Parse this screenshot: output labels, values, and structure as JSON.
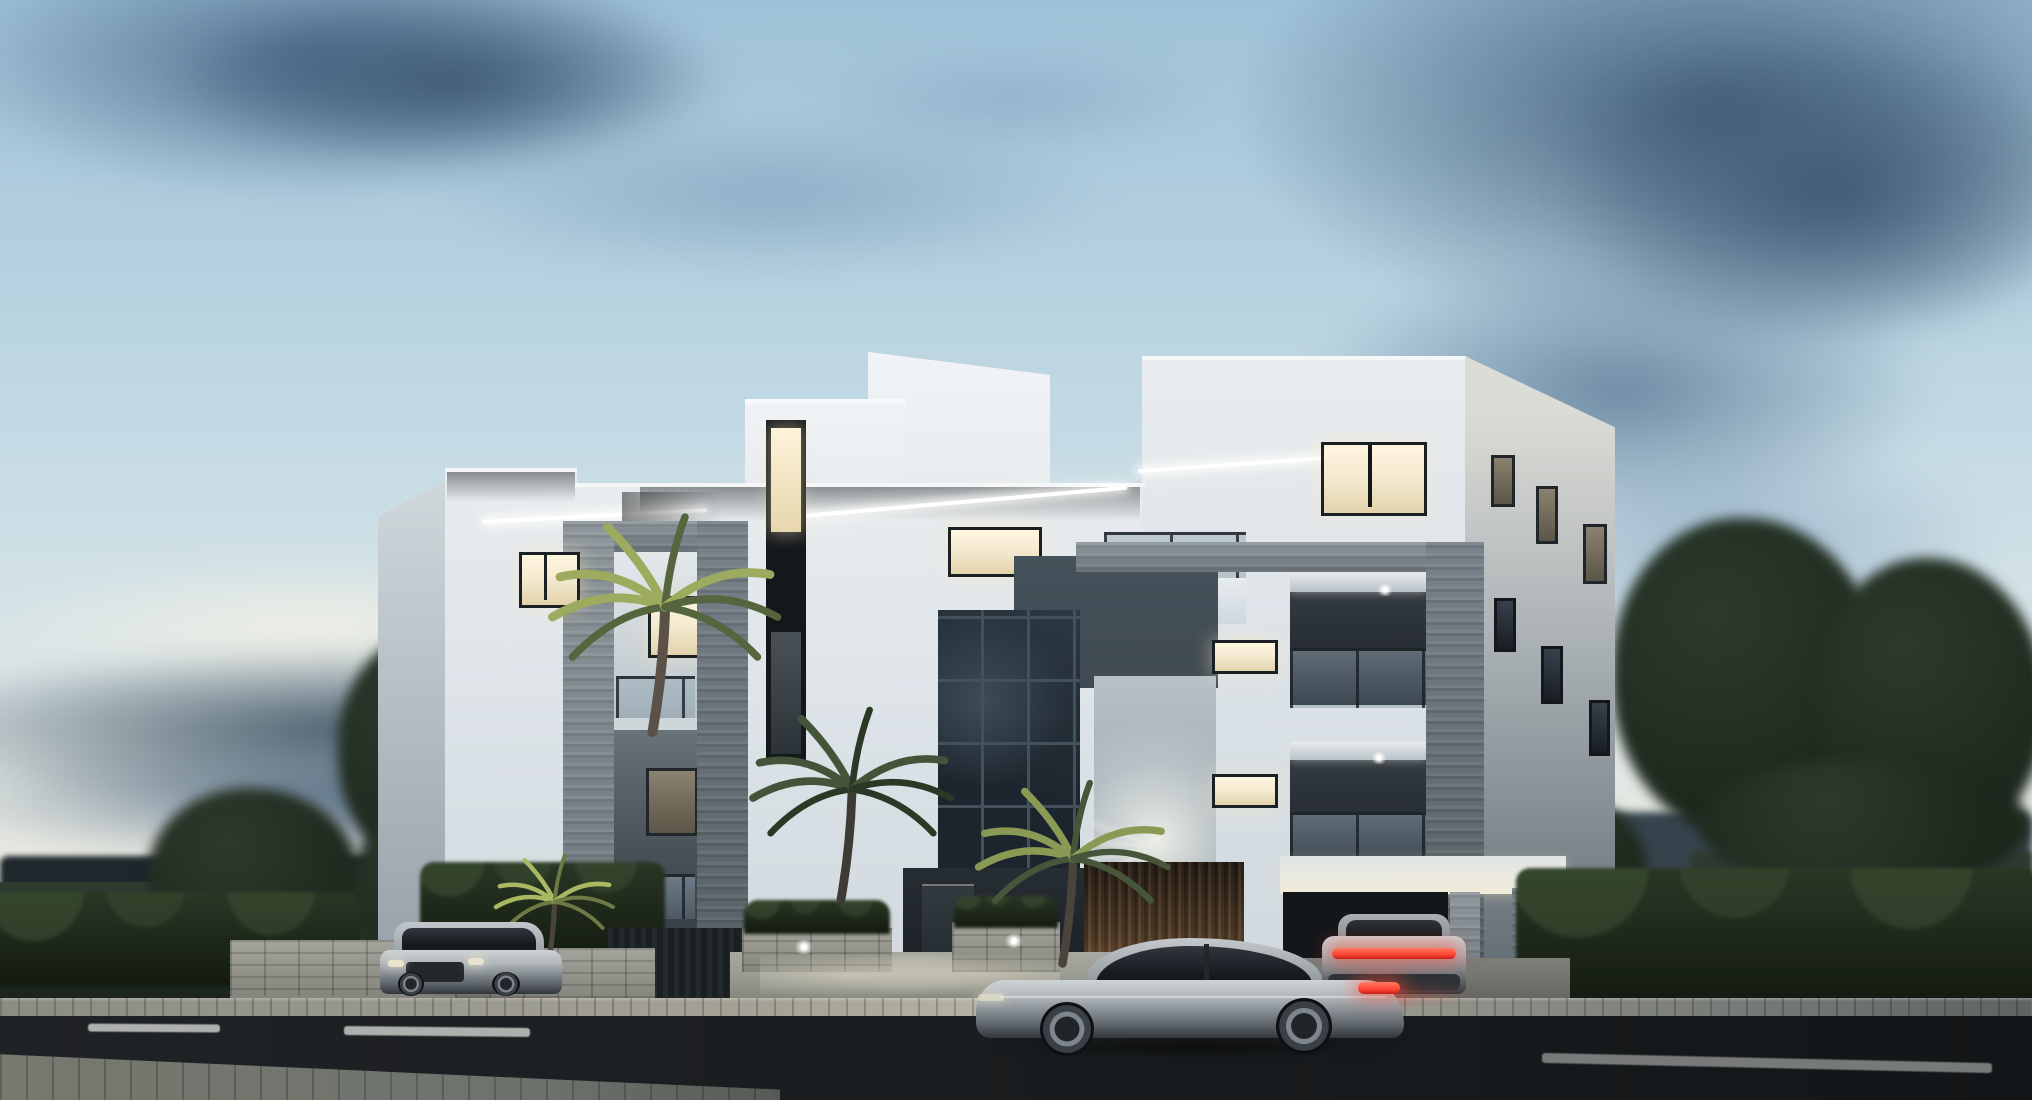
{
  "scene": {
    "description": "Dusk 3D architectural rendering of a modern flat-roof white apartment building with dark wood slat cladding, gray stone balcony portals, glass balustrades and warm lit windows; palm trees, trimmed hedges and lawns around it; a silver fastback sedan on the foreground road, a silver SUV on the left driveway and a parked car with a glowing red tail-light bar under the right carport; partly cloudy blue evening sky with a large dark cloud mass on the right.",
    "time_of_day": "dusk / early evening",
    "style": "photorealistic exterior visualization",
    "text_content": "none - the image contains no visible text"
  },
  "sky": {
    "condition": "partly cloudy dusk",
    "clouds": [
      "soft blue-gray cloud drift upper left",
      "small wisps top center",
      "large dark slate cloud mass upper right",
      "dark horizontal cloud band at the left horizon",
      "pale warm glow just above the horizon"
    ]
  },
  "building": {
    "type": "modern flat-roof apartment block, three storeys plus stepped rooftop volumes",
    "materials": [
      "white painted plaster",
      "dark walnut vertical wood-slat cladding",
      "gray split-face stone portal frames and pillars",
      "frameless glass balustrades",
      "dark aluminium window frames",
      "full-height dark staircase glazing"
    ],
    "lighting": [
      "warm interior lights in several windows",
      "linear LED strips under the roof soffits",
      "recessed spots in balcony ceilings",
      "wall-washer fan of light above the entrance",
      "uplights on palms and wood entrance wall"
    ],
    "left_wing": {
      "lit_window": 1,
      "stone_portal_balconies": 2
    },
    "center": {
      "tall_window_strip": "triple-height strip window, lit at top and middle",
      "wood_band_windows": 2,
      "staircase_glass_wall": "dark glazed grid",
      "entrance": "recessed dark door beside warm-lit wood slat wall"
    },
    "right_tower": {
      "lit_corner_window": "wide kitchen window, warm light",
      "balcony_levels": 2,
      "small_side_windows": 6,
      "carport": "flat canopy on stone pillars sheltering a parked car"
    }
  },
  "vehicles": [
    {
      "name": "suv-driveway",
      "type": "SUV",
      "color": "silver",
      "position": "left driveway entrance, front three-quarter view",
      "lights": "dim headlights"
    },
    {
      "name": "sedan-street",
      "type": "fastback sedan",
      "color": "silver",
      "position": "foreground road, heading left",
      "lights": "red tail lamp lit"
    },
    {
      "name": "car-carport",
      "type": "sedan seen from rear",
      "color": "silver gray",
      "position": "under right carport",
      "lights": "full-width red tail-light bar glowing"
    }
  ],
  "vegetation": {
    "palms": [
      {
        "name": "palm-large",
        "position": "in front of the tall window strip",
        "lighting": "uplit bright yellow-green fronds"
      },
      {
        "name": "palm-center",
        "position": "in front of the staircase glazing",
        "lighting": "mostly dark silhouette"
      },
      {
        "name": "palm-entrance",
        "position": "right of the entrance walkway",
        "lighting": "warm uplight"
      },
      {
        "name": "palm-driveway",
        "position": "behind the parked SUV",
        "lighting": "bright uplit fronds"
      }
    ],
    "trees": [
      "round deciduous tree on the far left lawn",
      "tall deciduous tree beside the left facade",
      "tree group on the far right behind the hedge",
      "small dark tree behind the carport"
    ],
    "hedges": [
      "trimmed hedge along the left boundary",
      "tall hedge behind the driveway",
      "long trimmed hedge along the right boundary"
    ],
    "grass": "dark lawn on the left with a distant tree line and fields"
  },
  "road": {
    "surface": "dark two-lane asphalt running across the foreground",
    "markings": [
      "short white dash far left",
      "white center dash left of the sedan",
      "long faded lane line on the right"
    ],
    "curb": "light concrete curb band, brightest in front of the lit entrance",
    "sidewalk": "paved strip in the near left foreground"
  },
  "palette": {
    "sky-top": "#9fc2d8",
    "sky-mid": "#c0d8e3",
    "sky-low": "#d9e5e8",
    "sky-horizon": "#eae9e0",
    "cloud-soft": "#7e9fbb",
    "cloud-dark": "#51708e",
    "cloud-deep": "#3f5a75",
    "cloud-band": "#475b6a",
    "building-white": "#e8ecef",
    "building-tint": "#dae1e6",
    "building-shade": "#aeb9c1",
    "wood-dark": "#382a1e",
    "wood-mid": "#5a442e",
    "wood-lit": "#8a6544",
    "stone": "#8e979c",
    "stone-dark": "#6b747a",
    "glass-dark": "#1c252d",
    "glass-mullion": "#44515b",
    "recess-dark": "#2b3238",
    "panel-slate": "#3f4a52",
    "window-warm": "#f5ebd2",
    "window-dim": "#7c7464",
    "led": "#ffffff",
    "veg-dark": "#1e291e",
    "veg-mid": "#2c3a2c",
    "veg-lit": "#9aab5e",
    "grass": "#243127",
    "treeline": "#1d272c",
    "hills": "#37444d",
    "hedge": "#1d2719",
    "fence": "#1a1f21",
    "ground-light": "#9b9d95",
    "curb": "#9a988c",
    "road": "#1a1d1f",
    "road-line": "#c7cbc6",
    "sidewalk": "#6e726d",
    "car-silver": "#b0b6ba",
    "car-dark": "#585f65",
    "tire": "#0e1113",
    "taillight": "#ff4634",
    "headlight": "#eee8cf",
    "warm-glow": "#f6e9c8"
  }
}
